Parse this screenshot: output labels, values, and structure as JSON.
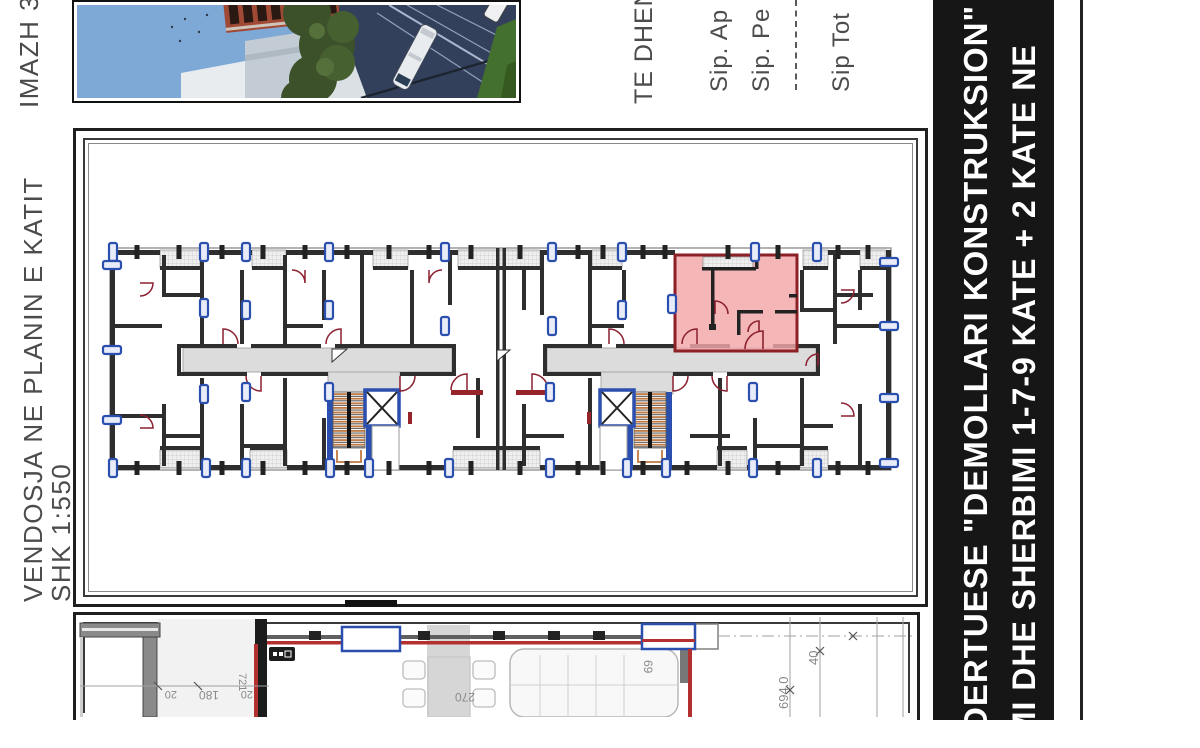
{
  "labels": {
    "photo_label": "IMAZH 3",
    "location_label": "VENDOSJA NE PLANIN E KATIT",
    "scale_label": "SHK 1:550"
  },
  "data_table": {
    "header": "TE DHEN",
    "row_apartment": "Sip. Ap",
    "row_second": "Sip. Pe",
    "row_total": "Sip Tot"
  },
  "title_bar": {
    "line1": "DERTUESE \"DEMOLLARI KONSTRUKSION\"",
    "line2": "IMI DHE SHERBIMI 1-7-9 KATE + 2 KATE NE",
    "bg": "#161616",
    "fg": "#ffffff"
  },
  "detail_plan": {
    "dims": {
      "left_a": "20",
      "left_b": "180",
      "left_c": "721",
      "left_d": "20",
      "table_width": "270",
      "sofa_depth": "69",
      "right_total": "694.0",
      "right_partial": "40"
    }
  },
  "colors": {
    "highlight_fill": "#f2a6a6",
    "highlight_border": "#8b2026",
    "window_blue": "#2a4fae",
    "stair_orange": "#c07840",
    "door_arc_red": "#8b2030",
    "corridor_gray": "#dcdcdc"
  }
}
